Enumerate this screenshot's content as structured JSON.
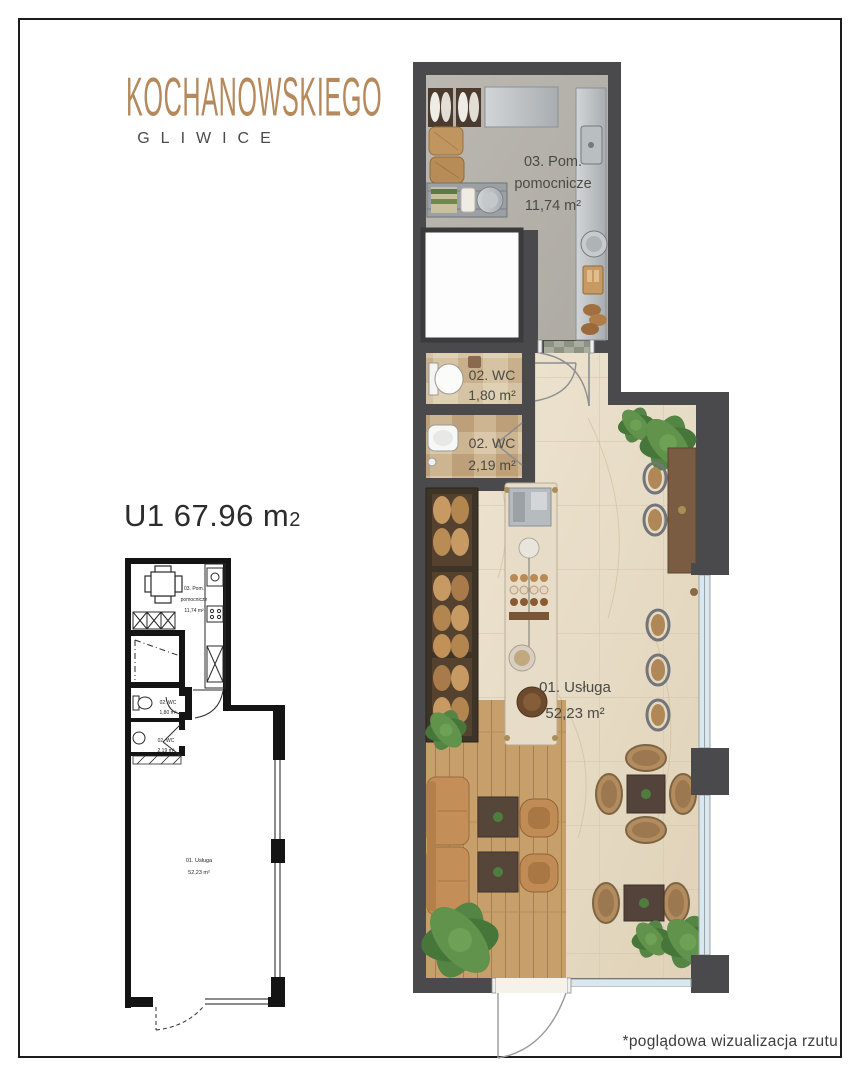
{
  "brand": {
    "name": "KOCHANOWSKIEGO",
    "city": "GLIWICE"
  },
  "unit": {
    "label": "U1 67.96 m",
    "sup": "2"
  },
  "rooms": {
    "aux": {
      "l1": "03. Pom.",
      "l2": "pomocnicze",
      "area": "11,74 m²"
    },
    "wc1": {
      "name": "02. WC",
      "area": "1,80 m²"
    },
    "wc2": {
      "name": "02. WC",
      "area": "2,19 m²"
    },
    "service": {
      "name": "01. Usługa",
      "area": "52,23 m²"
    }
  },
  "footnote": "*poglądowa wizualizacja rzutu",
  "colors": {
    "accent": "#b5895c",
    "wall_dark": "#4a4a4c",
    "mini_wall": "#141414",
    "marble": "#e9dfcc",
    "concrete": "#b6b3ac",
    "wood": "#c79f6a",
    "window_glass": "#d9e7ee",
    "label_text": "#4b4a45"
  }
}
